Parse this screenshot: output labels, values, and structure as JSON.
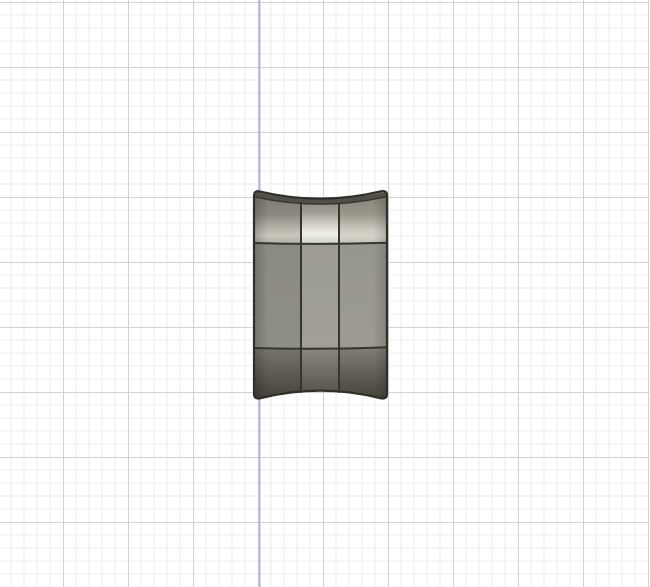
{
  "viewport": {
    "background": "#ffffff",
    "grid": {
      "minor_color": "#ececec",
      "major_color": "#d2d2d2",
      "axis_color": "#b7b4e4"
    },
    "model": {
      "name": "solid-body",
      "outline_color": "#2f2e29",
      "edge_color": "#35342e",
      "top_face_color": "#504e46",
      "highlight_color": "#efeee8",
      "gradients": {
        "band1_left": {
          "s0": "#7a776e",
          "s1": "#8b887f",
          "s2": "#b5b2a8",
          "s3": "#c9c6bc",
          "s4": "#b3b0a6"
        },
        "band1_mid": {
          "s0": "#7e7b72",
          "s1": "#a09d94",
          "s2": "#dddbd1",
          "s3": "#efeee8",
          "s4": "#d5d3c9"
        },
        "band1_right": {
          "s0": "#827f76",
          "s1": "#989589",
          "s2": "#ccc9bf",
          "s3": "#d5d2c8",
          "s4": "#c3c0b6"
        },
        "band2_left": {
          "s0": "#8c8b83",
          "s1": "#8f8e86"
        },
        "band2_mid": {
          "s0": "#9d9c94",
          "s1": "#a19f97"
        },
        "band2_right": {
          "s0": "#98978e",
          "s1": "#9c9a92"
        },
        "band3_left": {
          "s0": "#797670",
          "s1": "#5e5b54",
          "s2": "#42403a"
        },
        "band3_mid": {
          "s0": "#8b8880",
          "s1": "#6e6b63",
          "s2": "#4c4a43"
        },
        "band3_right": {
          "s0": "#827f77",
          "s1": "#635f58",
          "s2": "#454338"
        }
      }
    }
  }
}
